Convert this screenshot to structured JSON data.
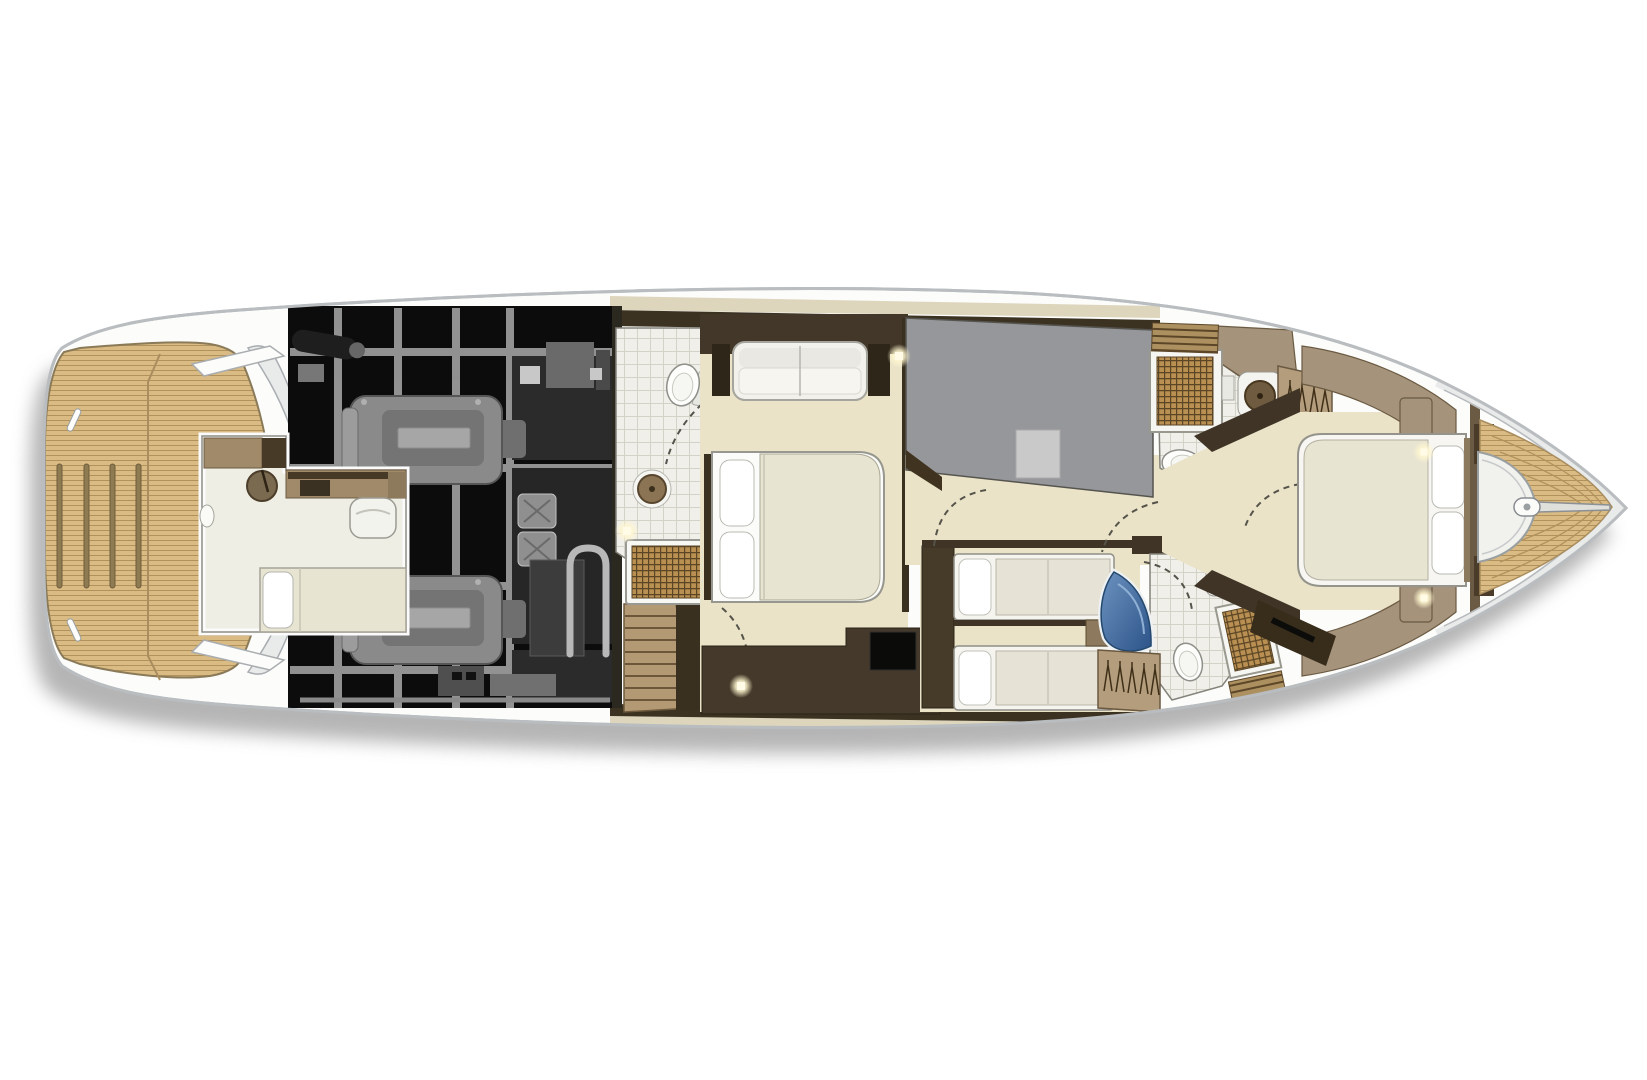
{
  "title": "Motor yacht lower deck floor plan — overhead cutaway view",
  "figure": {
    "kind": "floor-plan",
    "orientation": "bow-right, stern-left",
    "labels_visible": false,
    "render_style": "color interior with x-ray grayscale engine room"
  },
  "colors": {
    "page-bg": "#ffffff",
    "hull": "#fcfcfb",
    "hull-line": "#b9bdc0",
    "silver": "#e9eaea",
    "shadow": "#a3a3a3",
    "teak": "#d9bb83",
    "teak-line": "#b2925c",
    "teak-dark": "#8f7b52",
    "cream": "#eae3c8",
    "deck-cream": "#ddd6bd",
    "tile": "#f0efe9",
    "tile-line": "#d3d2c6",
    "grate": "#b98f52",
    "grate-line": "#5a4524",
    "slat": "#ad9060",
    "slat-line": "#5c4628",
    "brown": "#a08a6a",
    "taupe": "#a5937c",
    "walnut": "#6b5a44",
    "brown-dark": "#3f3426",
    "espresso": "#2c2417",
    "gray-room": "#96979a",
    "rug": "#c9c9c9",
    "engine-bg": "#0c0c0c",
    "frame-gray": "#9e9e9e",
    "machine": "#8a8a8a",
    "machine-dark": "#3a3a3a",
    "furniture-white": "#f5f4ef",
    "mattress": "#e8e4d2",
    "pillow": "#ffffff",
    "basin-blue": "#3f6da3",
    "basin-blue-deep": "#24496f",
    "glow": "#fffbe6",
    "outline": "#55534a"
  },
  "areas": [
    {
      "id": "swim-platform",
      "label": "Teak swim platform with deck slats"
    },
    {
      "id": "transom-arc",
      "label": "Curved transom with side-deck hatches"
    },
    {
      "id": "engine-room",
      "label": "Engine room shown in grayscale x-ray with twin engines"
    },
    {
      "id": "crew-cabin",
      "label": "Crew cabin with berth, seat, galley counter and basin"
    },
    {
      "id": "companionway-stairs",
      "label": "Companionway stairs"
    },
    {
      "id": "master-head",
      "label": "Master bathroom with toilet, basin and teak-grate shower"
    },
    {
      "id": "master-cabin",
      "label": "Master cabin with island double bed, sofa and TV cabinet"
    },
    {
      "id": "walk-in-wardrobe",
      "label": "Walk-in wardrobe / dressing room (gray floor)"
    },
    {
      "id": "lobby",
      "label": "Lower lobby with door swings"
    },
    {
      "id": "twin-cabin",
      "label": "Twin guest cabin with two single berths"
    },
    {
      "id": "day-head",
      "label": "Guest bathroom aft with blue corner basin and shower"
    },
    {
      "id": "forward-head",
      "label": "Forward bathroom with shower, toilet and round basin"
    },
    {
      "id": "vip-cabin",
      "label": "VIP bow cabin with island double bed"
    },
    {
      "id": "foredeck",
      "label": "Teak foredeck with anchor locker, windlass and anchor track"
    }
  ],
  "fixtures": {
    "engines": 2,
    "toilets": 3,
    "showers": 3,
    "round-washbasins": 4,
    "blue-corner-basin": 1,
    "berths": {
      "master-double": 1,
      "vip-double": 1,
      "twin-singles": 2,
      "crew-berth": 1
    },
    "hanging-lockers": 2,
    "windlass": 1,
    "ceiling-lights": 5,
    "door-swings": 7
  }
}
